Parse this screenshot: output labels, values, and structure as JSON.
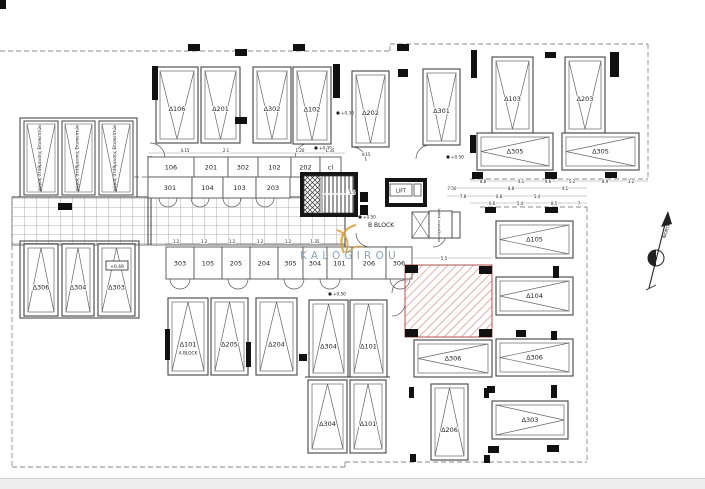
{
  "colors": {
    "line": "#3a3a3a",
    "hatch_red": "#cf8a8a",
    "watermark_gold": "#d7a244",
    "watermark_blue": "#7d94aa"
  },
  "watermark": {
    "brand": "KALOGIROU"
  },
  "compass": {
    "label": "NORTH"
  },
  "stair_core": {
    "lift_label": "LIFT",
    "block_label": "B BLOCK"
  },
  "plan": {
    "parking_spaces": [
      {
        "label": "Δ106",
        "x": 156,
        "y": 67,
        "w": 42,
        "h": 76,
        "dir": "down"
      },
      {
        "label": "Δ201",
        "x": 201,
        "y": 67,
        "w": 39,
        "h": 76,
        "dir": "down"
      },
      {
        "label": "Δ302",
        "x": 253,
        "y": 67,
        "w": 38,
        "h": 76,
        "dir": "down"
      },
      {
        "label": "Δ102",
        "x": 293,
        "y": 67,
        "w": 38,
        "h": 77,
        "dir": "down"
      },
      {
        "label": "Δ202",
        "x": 352,
        "y": 71,
        "w": 37,
        "h": 76,
        "dir": "down"
      },
      {
        "label": "Δ301",
        "x": 423,
        "y": 69,
        "w": 37,
        "h": 76,
        "dir": "down"
      },
      {
        "label": "Δ103",
        "x": 492,
        "y": 57,
        "w": 41,
        "h": 76,
        "dir": "down"
      },
      {
        "label": "Δ203",
        "x": 565,
        "y": 57,
        "w": 40,
        "h": 76,
        "dir": "down"
      },
      {
        "label": "Δ305",
        "x": 477,
        "y": 133,
        "w": 76,
        "h": 37,
        "dir": "left"
      },
      {
        "label": "Δ305",
        "x": 562,
        "y": 133,
        "w": 77,
        "h": 37,
        "dir": "left"
      },
      {
        "label": "Δ105",
        "x": 496,
        "y": 221,
        "w": 77,
        "h": 37,
        "dir": "left"
      },
      {
        "label": "Δ104",
        "x": 496,
        "y": 277,
        "w": 77,
        "h": 38,
        "dir": "left"
      },
      {
        "label": "Δ306",
        "x": 496,
        "y": 339,
        "w": 77,
        "h": 37,
        "dir": "left"
      },
      {
        "label": "Δ306",
        "x": 414,
        "y": 340,
        "w": 78,
        "h": 37,
        "dir": "left"
      },
      {
        "label": "Δ303",
        "x": 492,
        "y": 401,
        "w": 76,
        "h": 38,
        "dir": "right"
      },
      {
        "label": "Δ101",
        "x": 168,
        "y": 298,
        "w": 40,
        "h": 77,
        "dir": "up",
        "sub": "A BLOCK"
      },
      {
        "label": "Δ205",
        "x": 211,
        "y": 298,
        "w": 37,
        "h": 77,
        "dir": "up"
      },
      {
        "label": "Δ204",
        "x": 256,
        "y": 298,
        "w": 41,
        "h": 77,
        "dir": "up"
      },
      {
        "label": "Δ304",
        "x": 309,
        "y": 300,
        "w": 39,
        "h": 77,
        "dir": "up"
      },
      {
        "label": "Δ101",
        "x": 350,
        "y": 300,
        "w": 37,
        "h": 77,
        "dir": "up"
      },
      {
        "label": "Δ304",
        "x": 308,
        "y": 380,
        "w": 39,
        "h": 73,
        "dir": "up"
      },
      {
        "label": "Δ101",
        "x": 350,
        "y": 380,
        "w": 36,
        "h": 73,
        "dir": "up"
      },
      {
        "label": "Δ206",
        "x": 431,
        "y": 384,
        "w": 37,
        "h": 76,
        "dir": "up"
      },
      {
        "label": "Δ306",
        "x": 24,
        "y": 244,
        "w": 34,
        "h": 72,
        "dir": "up"
      },
      {
        "label": "Δ304",
        "x": 62,
        "y": 244,
        "w": 32,
        "h": 72,
        "dir": "up"
      },
      {
        "label": "Δ303",
        "x": 98,
        "y": 244,
        "w": 37,
        "h": 72,
        "dir": "up"
      }
    ],
    "visitor": {
      "label": "χώρος στάθμευσης Επισκεπτών",
      "spaces": [
        {
          "x": 24,
          "y": 121,
          "w": 34,
          "h": 74
        },
        {
          "x": 62,
          "y": 121,
          "w": 33,
          "h": 74
        },
        {
          "x": 99,
          "y": 121,
          "w": 34,
          "h": 74
        }
      ]
    },
    "storage_rows": [
      {
        "name": "row-a",
        "y": 157,
        "h": 20,
        "cells": [
          {
            "label": "106",
            "x": 148,
            "w": 46
          },
          {
            "label": "201",
            "x": 194,
            "w": 34
          },
          {
            "label": "302",
            "x": 228,
            "w": 30
          },
          {
            "label": "102",
            "x": 258,
            "w": 33
          },
          {
            "label": "202",
            "x": 291,
            "w": 29
          },
          {
            "label": "cl",
            "x": 320,
            "w": 21
          }
        ]
      },
      {
        "name": "row-b",
        "y": 177,
        "h": 21,
        "cells": [
          {
            "label": "301",
            "x": 148,
            "w": 44
          },
          {
            "label": "104",
            "x": 192,
            "w": 31
          },
          {
            "label": "103",
            "x": 223,
            "w": 33
          },
          {
            "label": "203",
            "x": 256,
            "w": 34
          }
        ]
      },
      {
        "name": "row-mid",
        "y": 247,
        "h": 32,
        "cells": [
          {
            "label": "303",
            "x": 166,
            "w": 28
          },
          {
            "label": "105",
            "x": 194,
            "w": 28
          },
          {
            "label": "205",
            "x": 222,
            "w": 28
          },
          {
            "label": "204",
            "x": 250,
            "w": 28
          },
          {
            "label": "305",
            "x": 278,
            "w": 25
          },
          {
            "label": "304",
            "x": 303,
            "w": 24
          },
          {
            "label": "101",
            "x": 327,
            "w": 25
          },
          {
            "label": "206",
            "x": 352,
            "w": 34
          },
          {
            "label": "306",
            "x": 386,
            "w": 26
          }
        ]
      }
    ],
    "utility_room_label": "κοινόχρηστος χώρος",
    "elevation_markers": [
      {
        "text": "+0.30",
        "x": 316,
        "y": 148
      },
      {
        "text": "+0.30",
        "x": 338,
        "y": 113
      },
      {
        "text": "+0.50",
        "x": 448,
        "y": 157
      },
      {
        "text": "+0.50",
        "x": 360,
        "y": 217
      },
      {
        "text": "+0.50",
        "x": 330,
        "y": 294
      }
    ],
    "level_badge": {
      "text": "+0.49",
      "x": 108,
      "y": 267
    },
    "dimension_labels": [
      {
        "t": "4.15",
        "x": 185,
        "y": 152
      },
      {
        "t": "2.1",
        "x": 226,
        "y": 152
      },
      {
        "t": "1.20",
        "x": 300,
        "y": 152
      },
      {
        "t": "1.35",
        "x": 330,
        "y": 152
      },
      {
        "t": "4.15",
        "x": 366,
        "y": 156
      },
      {
        "t": "5.4",
        "x": 352,
        "y": 194
      },
      {
        "t": "8.8",
        "x": 483,
        "y": 183
      },
      {
        "t": "4.1",
        "x": 521,
        "y": 183
      },
      {
        "t": "9.6",
        "x": 548,
        "y": 183
      },
      {
        "t": "5.2",
        "x": 572,
        "y": 183
      },
      {
        "t": "8.9",
        "x": 605,
        "y": 183
      },
      {
        "t": "3.2",
        "x": 631,
        "y": 183
      },
      {
        "t": "7.50",
        "x": 452,
        "y": 190
      },
      {
        "t": "8.8",
        "x": 511,
        "y": 190
      },
      {
        "t": "4.1",
        "x": 565,
        "y": 190
      },
      {
        "t": "7.8",
        "x": 463,
        "y": 198
      },
      {
        "t": "0.8",
        "x": 499,
        "y": 198
      },
      {
        "t": "5.4",
        "x": 537,
        "y": 198
      },
      {
        "t": "6.6",
        "x": 492,
        "y": 205
      },
      {
        "t": "5.4",
        "x": 520,
        "y": 205
      },
      {
        "t": "8.5",
        "x": 554,
        "y": 205
      },
      {
        "t": "7",
        "x": 579,
        "y": 205
      },
      {
        "t": "1.2",
        "x": 176,
        "y": 243
      },
      {
        "t": "1.2",
        "x": 204,
        "y": 243
      },
      {
        "t": "1.2",
        "x": 232,
        "y": 243
      },
      {
        "t": "1.2",
        "x": 260,
        "y": 243
      },
      {
        "t": "1.2",
        "x": 288,
        "y": 243
      },
      {
        "t": "1.35",
        "x": 315,
        "y": 243
      },
      {
        "t": "5.5",
        "x": 444,
        "y": 260
      }
    ]
  }
}
